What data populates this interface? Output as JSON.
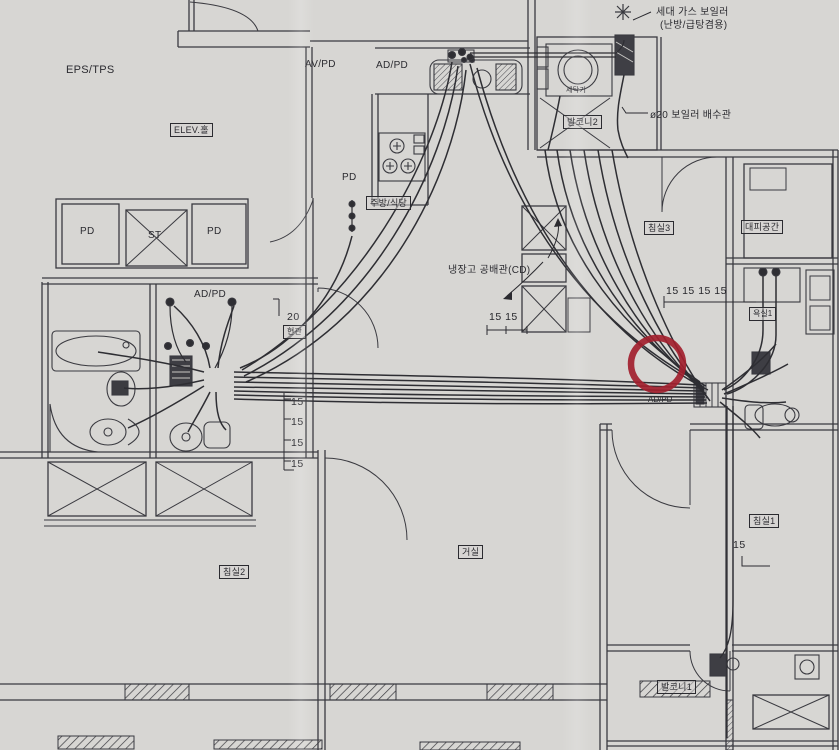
{
  "rooms": {
    "elev_hall": "ELEV.홀",
    "kitchen_dining": "주방/식당",
    "bedroom1": "침실1",
    "bedroom2": "침실2",
    "bedroom3": "침실3",
    "living": "거실",
    "bath1": "욕실1",
    "entrance": "현관",
    "balcony1": "발코니1",
    "balcony2": "발코니2",
    "evac_space": "대피공간"
  },
  "shafts": {
    "eps_tps": "EPS/TPS",
    "av_pd": "AV/PD",
    "ad_pd_kitchen": "AD/PD",
    "ad_pd_bath_left": "AD/PD",
    "ad_pd_bath_right": "AD/PD",
    "pd_left": "PD",
    "pd_right": "PD",
    "pd_kitchen": "PD",
    "st": "ST"
  },
  "equipment": {
    "boiler_title": "세대 가스 보일러",
    "boiler_subtitle": "(난방/급탕겸용)",
    "boiler_drain": "ø20 보일러 배수관",
    "fridge_conduit": "냉장고 공배관(CD)",
    "washer": "세탁기"
  },
  "dimensions": {
    "pair_kitchen": "15 15",
    "row_right": "15 15 15 15",
    "riser_left": [
      "15",
      "15",
      "15",
      "15"
    ],
    "size_20": "20",
    "size_15_right": "15"
  },
  "annotation": {
    "red_circle_color": "#a21f2e"
  }
}
